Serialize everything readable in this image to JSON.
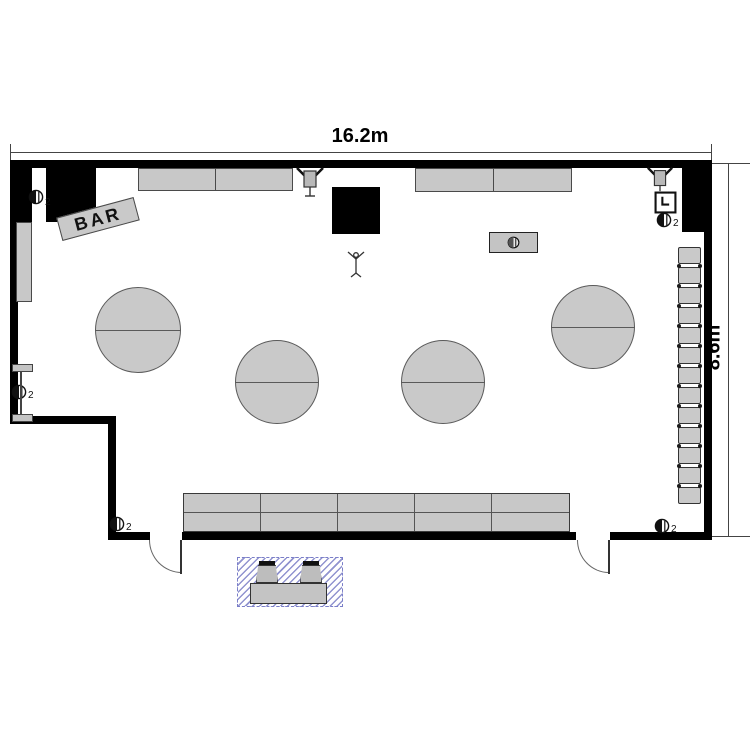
{
  "title": "Bar floor plan",
  "dimensions": {
    "width_label": "16.2m",
    "height_label": "8.6m"
  },
  "labels": {
    "bar_sign": "BAR"
  },
  "symbols": {
    "outlet_subscript": "2"
  },
  "icons": {
    "outlet": "half-filled-circle-outlet-icon",
    "wall_speaker": "wall-mounted-speaker-icon",
    "equipment_box": "l-mark-equipment-box-icon",
    "mic_stand": "mic-stand-figure-icon",
    "table_symbol": "round-table-with-split-line"
  },
  "counts": {
    "round_tables": 4,
    "right_stools": 13,
    "bottom_bench_columns": 5,
    "bottom_bench_rows": 2,
    "top_counter_segments": 2,
    "wall_outlets": 5,
    "outside_stools": 2,
    "doors": 2
  },
  "colors": {
    "wall": "#000000",
    "furniture_fill": "#c8c8c8",
    "furniture_border": "#4a4a4a",
    "hatch": "#9093cf",
    "dimension_line": "#444444"
  }
}
